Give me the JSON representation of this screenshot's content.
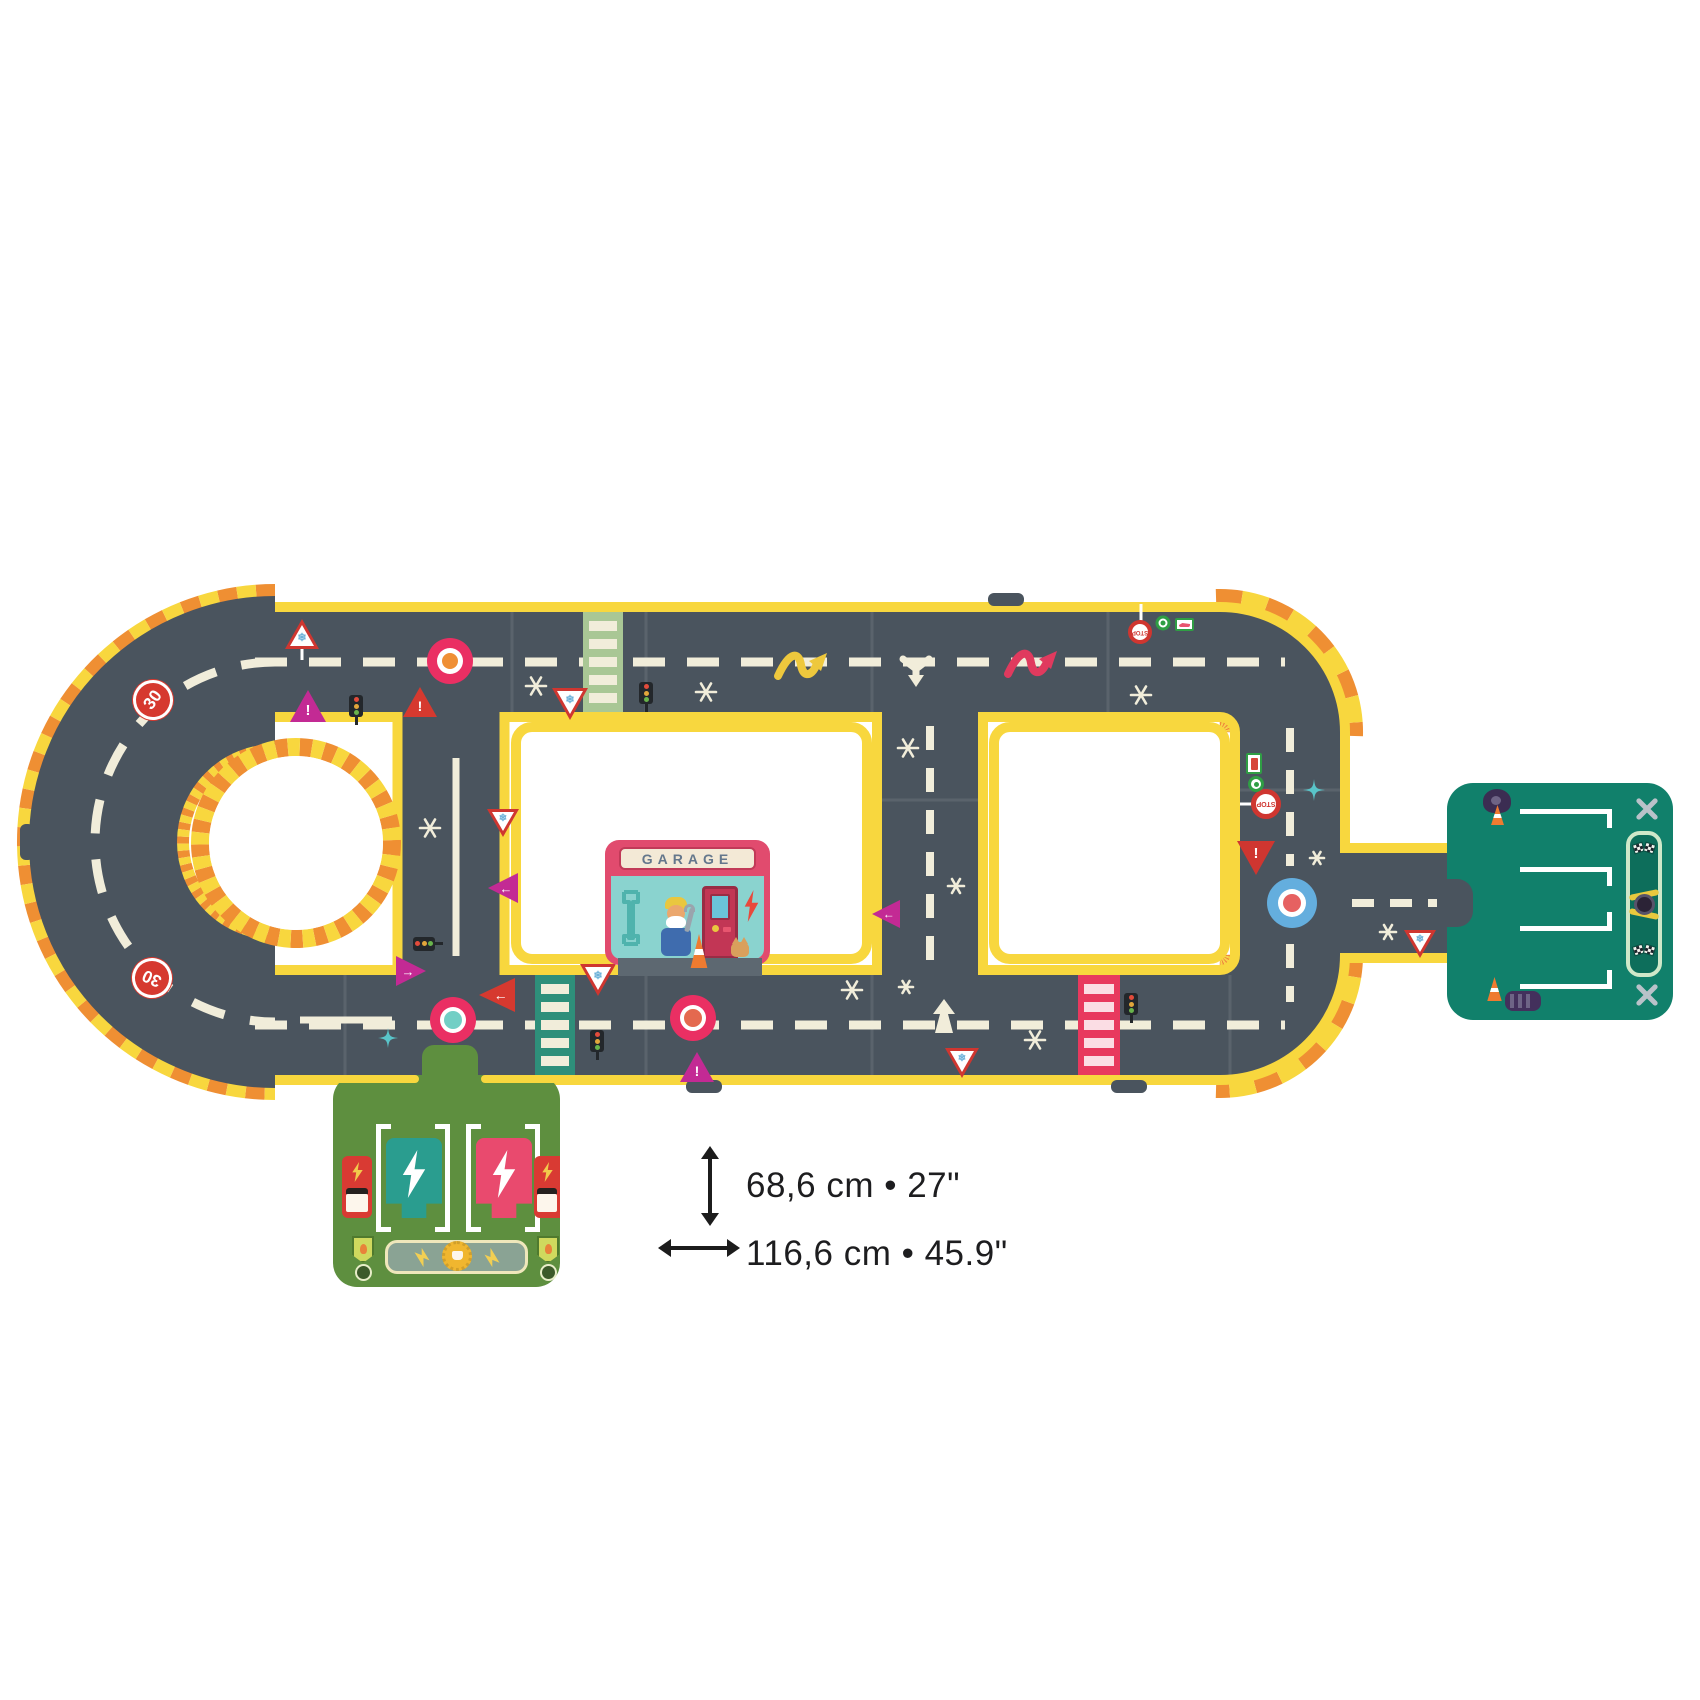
{
  "product": {
    "type": "giant-puzzle-road-track",
    "garage_sign": "GARAGE",
    "speed_limit_sign": "30",
    "stop_sign": "STOP"
  },
  "dimensions": {
    "height_label": "68,6 cm • 27\"",
    "width_label": "116,6 cm • 45.9\""
  },
  "icons": {
    "snowflake": "❄",
    "exclamation": "!",
    "arrow_left": "←",
    "arrow_right": "→"
  },
  "colors": {
    "road": "#4a545e",
    "edge_yellow": "#f8d73e",
    "hazard_orange": "#ef8f33",
    "marking_cream": "#f1edda",
    "roundabout_pink": "#ea2f63",
    "roundabout_blue": "#64aede",
    "sign_magenta": "#c32a94",
    "sign_red": "#d6392f",
    "garage_pink": "#e14b6e",
    "garage_teal": "#8ad3cf",
    "parking_green": "#11806b",
    "station_green": "#5e8f3f"
  }
}
